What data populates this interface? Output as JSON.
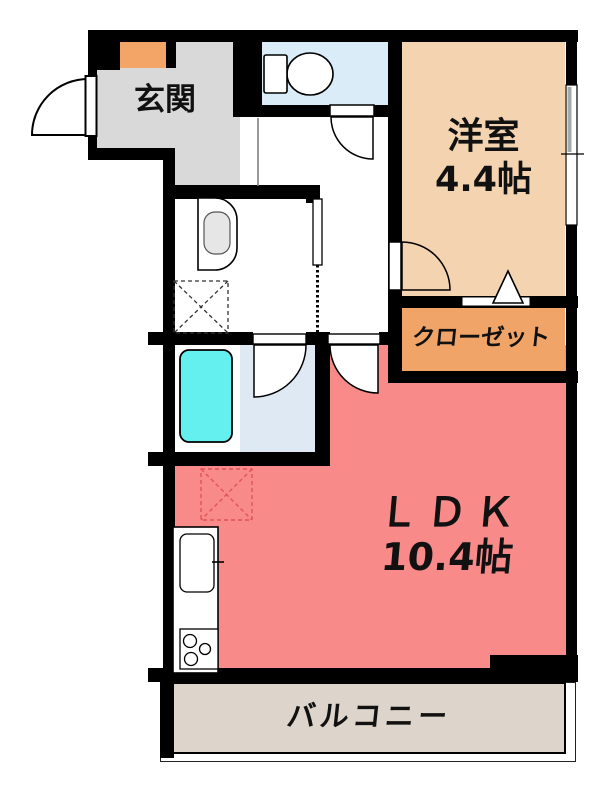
{
  "plan": {
    "rooms": {
      "genkan": {
        "label": "玄関"
      },
      "western_room": {
        "label": "洋室",
        "size": "4.4帖"
      },
      "closet": {
        "label": "クローゼット"
      },
      "ldk": {
        "label": "ＬＤＫ",
        "size": "10.4帖"
      },
      "balcony": {
        "label": "バルコニー"
      }
    },
    "colors": {
      "wall": "#000000",
      "genkan_floor": "#d9d9d9",
      "western_room_floor": "#f4d3b0",
      "closet_floor": "#f0a468",
      "ldk_floor": "#f98a8a",
      "balcony_floor": "#ddd5cb",
      "toilet_floor": "#d9ecf8",
      "bathroom_floor": "#dfe9f4",
      "bathtub": "#63f0ee",
      "shoe_cabinet": "#f2a566",
      "refrigerator_outline": "#e05555"
    },
    "fixtures": [
      "toilet",
      "washbasin",
      "bathtub",
      "washing-machine-space",
      "refrigerator-space",
      "kitchen-sink",
      "gas-stove",
      "shoe-cabinet",
      "entrance-door",
      "toilet-door",
      "bathroom-door",
      "ldk-door",
      "western-room-door",
      "washroom-sliding-door",
      "closet-folding-door-mark",
      "window"
    ]
  }
}
